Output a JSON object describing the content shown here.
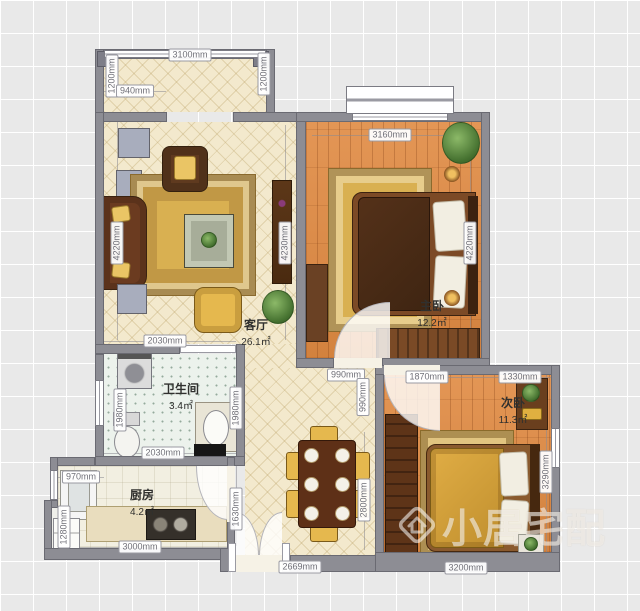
{
  "watermark": {
    "text": "小居宅配",
    "logo": "house-diamond-logo"
  },
  "rooms": [
    {
      "name": "客厅",
      "area": "26.1㎡",
      "x": 256,
      "y": 316
    },
    {
      "name": "主卧",
      "area": "12.2㎡",
      "x": 432,
      "y": 297
    },
    {
      "name": "卫生间",
      "area": "3.4㎡",
      "x": 181,
      "y": 380
    },
    {
      "name": "厨房",
      "area": "4.2㎡",
      "x": 142,
      "y": 486
    },
    {
      "name": "次卧",
      "area": "11.3㎡",
      "x": 513,
      "y": 394
    }
  ],
  "dimensions": [
    {
      "text": "3100mm",
      "x": 190,
      "y": 55,
      "orient": "h"
    },
    {
      "text": "1200mm",
      "x": 112,
      "y": 76,
      "orient": "v"
    },
    {
      "text": "1200mm",
      "x": 264,
      "y": 74,
      "orient": "v"
    },
    {
      "text": "940mm",
      "x": 135,
      "y": 91,
      "orient": "h"
    },
    {
      "text": "4220mm",
      "x": 117,
      "y": 243,
      "orient": "v"
    },
    {
      "text": "4230mm",
      "x": 285,
      "y": 243,
      "orient": "v"
    },
    {
      "text": "3160mm",
      "x": 390,
      "y": 135,
      "orient": "h"
    },
    {
      "text": "4220mm",
      "x": 470,
      "y": 243,
      "orient": "v"
    },
    {
      "text": "2030mm",
      "x": 165,
      "y": 341,
      "orient": "h"
    },
    {
      "text": "1980mm",
      "x": 120,
      "y": 410,
      "orient": "v"
    },
    {
      "text": "1980mm",
      "x": 236,
      "y": 408,
      "orient": "v"
    },
    {
      "text": "2030mm",
      "x": 163,
      "y": 453,
      "orient": "h"
    },
    {
      "text": "990mm",
      "x": 346,
      "y": 375,
      "orient": "h"
    },
    {
      "text": "990mm",
      "x": 363,
      "y": 397,
      "orient": "v"
    },
    {
      "text": "1870mm",
      "x": 427,
      "y": 377,
      "orient": "h"
    },
    {
      "text": "1330mm",
      "x": 520,
      "y": 377,
      "orient": "h"
    },
    {
      "text": "3290mm",
      "x": 546,
      "y": 472,
      "orient": "v"
    },
    {
      "text": "3200mm",
      "x": 466,
      "y": 568,
      "orient": "h"
    },
    {
      "text": "970mm",
      "x": 81,
      "y": 477,
      "orient": "h"
    },
    {
      "text": "1280mm",
      "x": 64,
      "y": 527,
      "orient": "v"
    },
    {
      "text": "3000mm",
      "x": 140,
      "y": 547,
      "orient": "h"
    },
    {
      "text": "1630mm",
      "x": 236,
      "y": 509,
      "orient": "v"
    },
    {
      "text": "2800mm",
      "x": 364,
      "y": 500,
      "orient": "v"
    },
    {
      "text": "2669mm",
      "x": 300,
      "y": 567,
      "orient": "h"
    }
  ],
  "colors": {
    "wall": "#8d8d94",
    "floor_wood": "#e08a42",
    "floor_cream": "#f3e9cd",
    "floor_tile": "#ecf2ec",
    "floor_kitchen": "#f2efe1",
    "accent_gold": "#e5b84e"
  }
}
